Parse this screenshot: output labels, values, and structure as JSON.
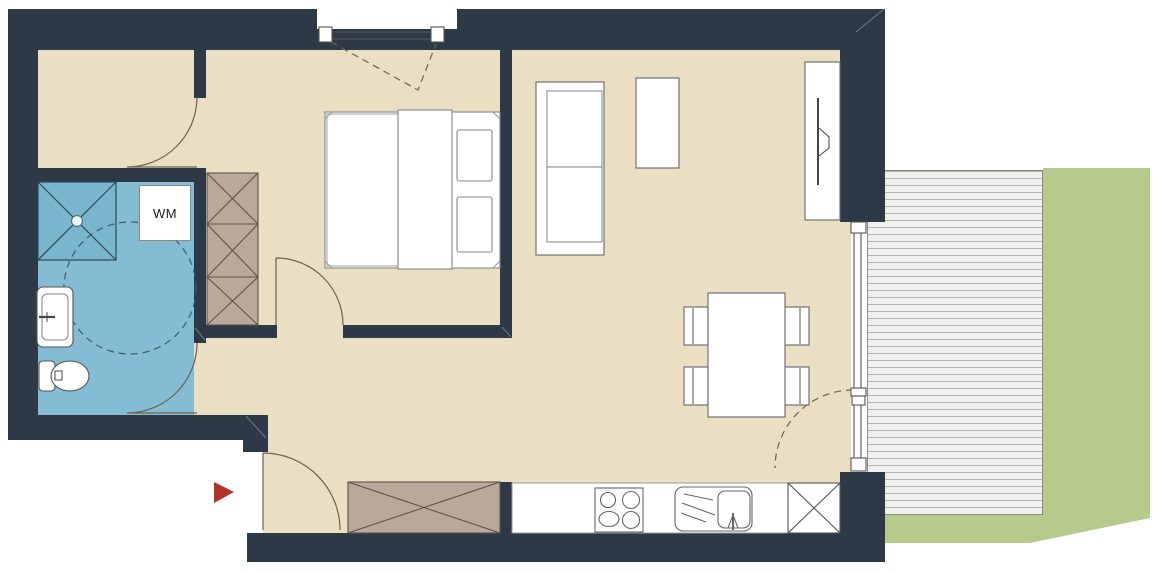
{
  "plan": {
    "kind": "apartment floor plan",
    "labels": {
      "washing_machine": "WM"
    },
    "rooms": [
      {
        "name": "storage-room"
      },
      {
        "name": "bathroom"
      },
      {
        "name": "bedroom"
      },
      {
        "name": "hallway"
      },
      {
        "name": "living-dining-room"
      },
      {
        "name": "kitchen-line"
      },
      {
        "name": "terrace"
      },
      {
        "name": "lawn"
      }
    ],
    "colors": {
      "wall": "#2e3947",
      "floor": "#eadfc3",
      "bathroom": "#84bcd4",
      "wardrobe": "#b8a99b",
      "wardrobe_line": "#5f5347",
      "deck": "#efefed",
      "deck_line": "#b3b3b1",
      "lawn": "#b6ca8c",
      "entrance_arrow": "#b23227",
      "door_line": "#70614f",
      "furniture_line": "#666666",
      "window_line": "#555555",
      "dash_line": "#3d5a6b"
    }
  }
}
